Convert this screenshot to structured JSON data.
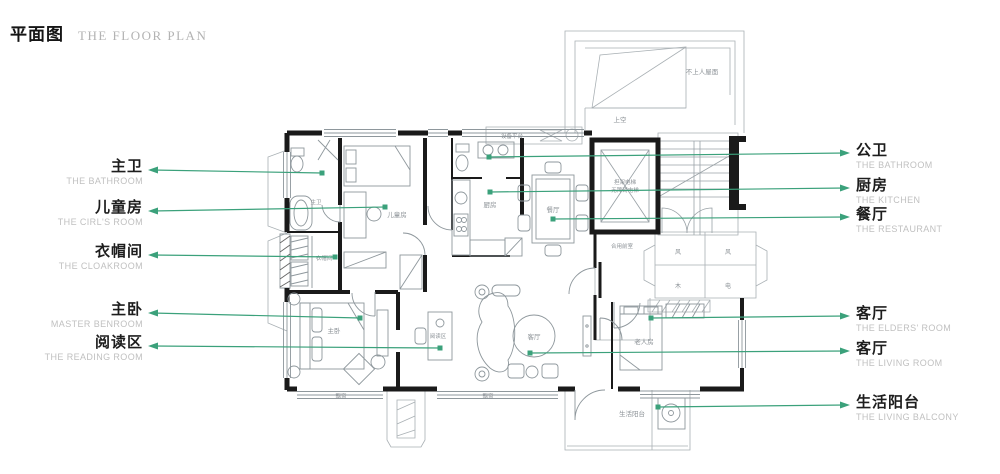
{
  "header": {
    "title_zh": "平面图",
    "title_en": "THE FLOOR PLAN"
  },
  "colors": {
    "accent": "#3BA17B",
    "wall": "#1a1a1a",
    "drawing_line": "#98a0a5",
    "label_zh": "#1d1d1d",
    "label_en": "#c0c0c0"
  },
  "labels_left": [
    {
      "zh": "主卫",
      "en": "THE BATHROOM"
    },
    {
      "zh": "儿童房",
      "en": "THE CIRL'S ROOM"
    },
    {
      "zh": "衣帽间",
      "en": "THE CLOAKROOM"
    },
    {
      "zh": "主卧",
      "en": "MASTER BENROOM"
    },
    {
      "zh": "阅读区",
      "en": "THE READING ROOM"
    }
  ],
  "labels_right": [
    {
      "zh": "公卫",
      "en": "THE BATHROOM"
    },
    {
      "zh": "厨房",
      "en": "THE KITCHEN"
    },
    {
      "zh": "餐厅",
      "en": "THE RESTAURANT"
    },
    {
      "zh": "客厅",
      "en": "THE ELDERS' ROOM"
    },
    {
      "zh": "客厅",
      "en": "THE LIVING ROOM"
    },
    {
      "zh": "生活阳台",
      "en": "THE  LIVING BALCONY"
    }
  ],
  "plan_texts": {
    "roof": "不上人屋面",
    "void_above": "上空",
    "equipment": "设备平台",
    "kitchen": "厨房",
    "dining": "餐厅",
    "elevator_line1": "担架电梯",
    "elevator_line2": "无障碍电梯",
    "lobby": "合用前室",
    "kids_room": "儿童房",
    "master_bath": "主卫",
    "cloakroom": "衣帽间",
    "master_bed": "主卧",
    "reading": "阅读区",
    "living": "客厅",
    "elders_room": "老人房",
    "balcony": "生活阳台",
    "bay_window_1": "飘窗",
    "bay_window_2": "飘窗",
    "ac_cell_1": "风",
    "ac_cell_2": "风",
    "ac_cell_3": "木",
    "ac_cell_4": "电"
  }
}
